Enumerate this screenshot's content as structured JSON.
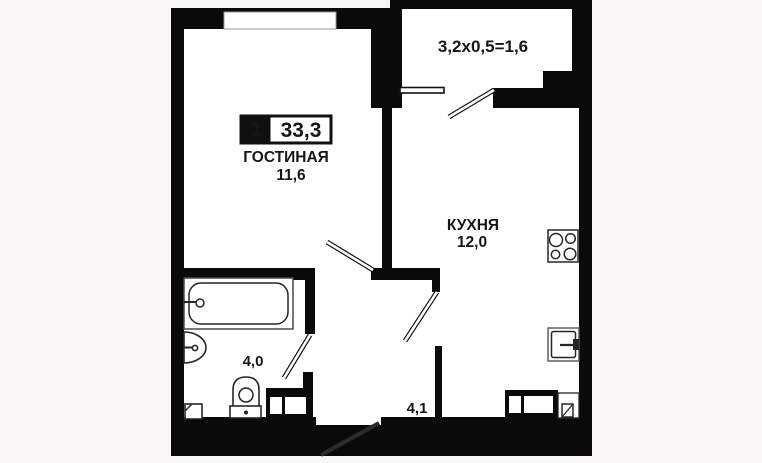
{
  "badge": {
    "rooms": "1",
    "total_area": "33,3"
  },
  "rooms": {
    "living": {
      "label": "ГОСТИНАЯ",
      "area": "11,6"
    },
    "kitchen": {
      "label": "КУХНЯ",
      "area": "12,0"
    },
    "bathroom": {
      "area": "4,0"
    },
    "hallway": {
      "area": "4,1"
    },
    "balcony": {
      "dimensions": "3,2x0,5=1,6"
    }
  },
  "colors": {
    "background": "#f7f6f2",
    "walls": "#0a0a0a",
    "floor": "#ffffff",
    "text": "#161616"
  }
}
